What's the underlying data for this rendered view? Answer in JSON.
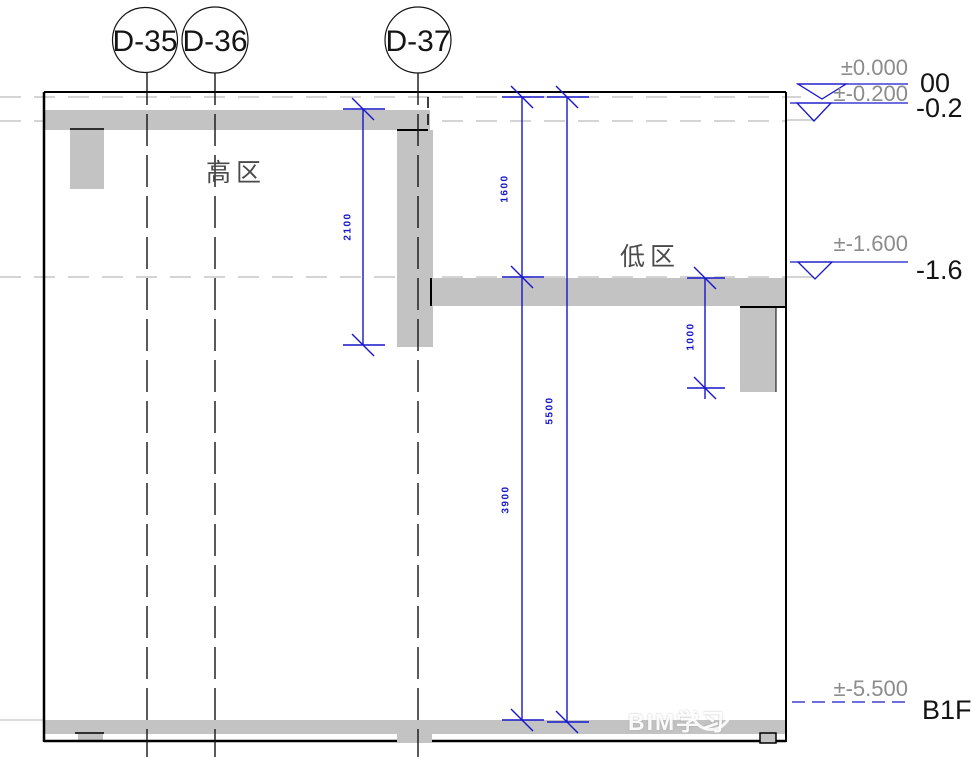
{
  "drawing": {
    "grids": [
      {
        "label": "D-35"
      },
      {
        "label": "D-36"
      },
      {
        "label": "D-37"
      }
    ],
    "zones": {
      "high": "高区",
      "low": "低区"
    },
    "dimensions": [
      {
        "value": "2100"
      },
      {
        "value": "1600"
      },
      {
        "value": "5500"
      },
      {
        "value": "3900"
      },
      {
        "value": "1000"
      }
    ],
    "levels": [
      {
        "elevation": "±0.000",
        "name": "00"
      },
      {
        "elevation": "±-0.200",
        "name": "-0.2"
      },
      {
        "elevation": "±-1.600",
        "name": "-1.6"
      },
      {
        "elevation": "±-5.500",
        "name": "B1F"
      }
    ],
    "watermark": "BIM学习",
    "colors": {
      "dimension_blue": "#1717c9",
      "slab_gray": "#c3c3c3",
      "level_text_gray": "#8c8c8c",
      "line_black": "#000000"
    }
  }
}
